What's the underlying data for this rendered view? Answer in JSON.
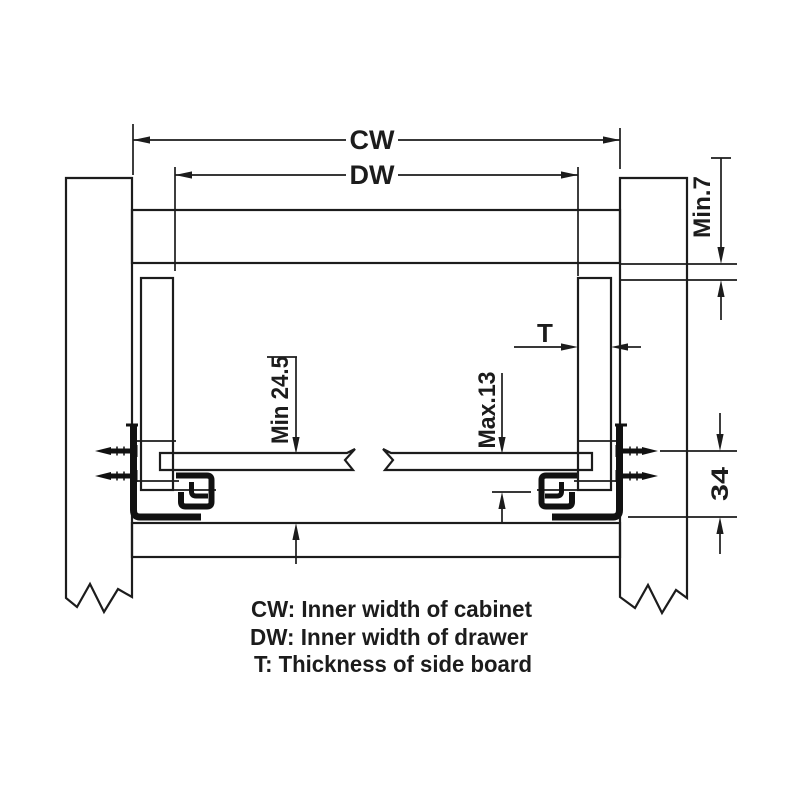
{
  "diagram": {
    "dimensions": {
      "cw_label": "CW",
      "dw_label": "DW",
      "t_label": "T",
      "top_clearance": "Min.7",
      "bottom_clearance": "Min 24.5",
      "drawer_bottom_offset": "Max.13",
      "slide_height": "34"
    },
    "legend": {
      "cw": "CW: Inner width of cabinet",
      "dw": "DW: Inner width of drawer",
      "t": "T: Thickness of side board"
    },
    "colors": {
      "line": "#1c1c1c",
      "background": "#ffffff"
    }
  }
}
